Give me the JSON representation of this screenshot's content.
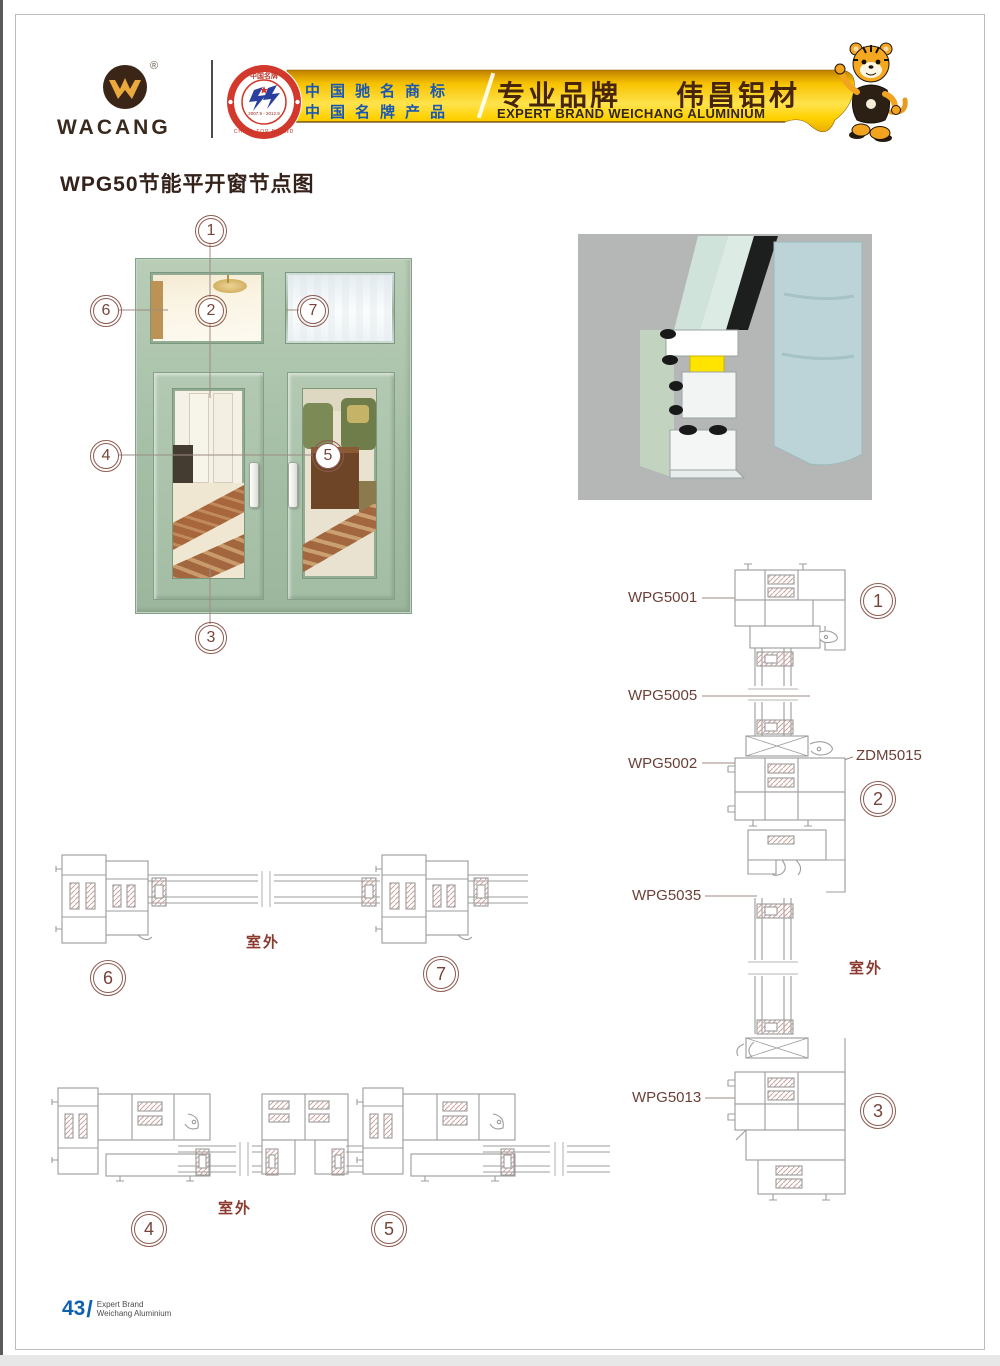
{
  "header": {
    "logo": {
      "brand": "WACANG",
      "reg": "®"
    },
    "badge": {
      "top_text": "中国名牌",
      "bottom_text": "CHINA TOP BRAND",
      "dates": "2007.9 - 2012.9"
    },
    "banner": {
      "claim1": "中国驰名商标",
      "claim2": "中国名牌产品",
      "slogan_cn": "专业品牌",
      "brand_cn": "伟昌铝材",
      "slogan_en": "EXPERT BRAND WEICHANG ALUMINIUM"
    }
  },
  "page_title": "WPG50节能平开窗节点图",
  "callouts": {
    "n1": "1",
    "n2": "2",
    "n3": "3",
    "n4": "4",
    "n5": "5",
    "n6": "6",
    "n7": "7"
  },
  "section_labels": {
    "wpg5001": "WPG5001",
    "wpg5005": "WPG5005",
    "wpg5002": "WPG5002",
    "zdm5015": "ZDM5015",
    "wpg5035": "WPG5035",
    "wpg5013": "WPG5013",
    "outdoor": "室外"
  },
  "footer": {
    "page_number": "43",
    "separator": "/",
    "line1": "Expert Brand",
    "line2": "Weichang Aluminium"
  },
  "colors": {
    "banner_gold": "#ffd100",
    "claim_blue": "#1857b4",
    "brand_brown": "#47250a",
    "callout_maroon": "#8d5a50",
    "frame_green": "#a5bfa6",
    "diagram_gray": "#9c9c9c",
    "footer_blue": "#1060b0"
  }
}
